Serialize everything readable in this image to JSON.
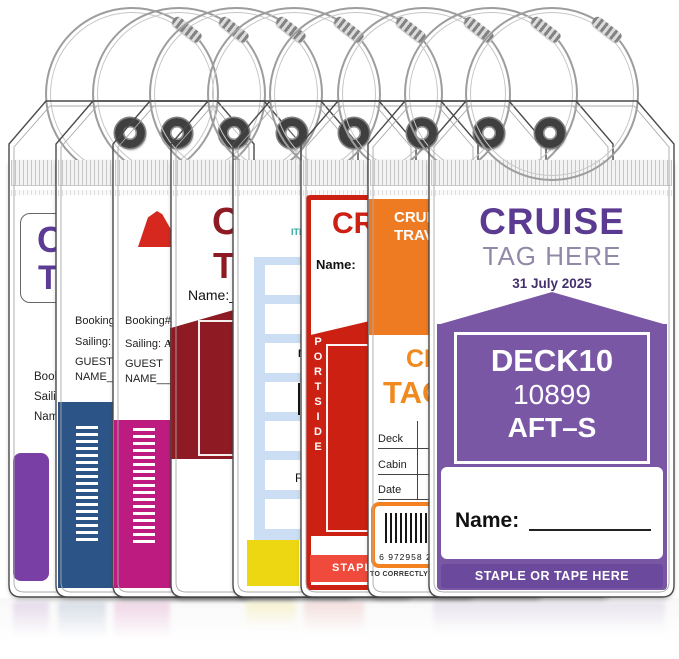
{
  "colors": {
    "front_purple_block": "#7A57A5",
    "front_purple_text": "#5B3A91",
    "front_staple_bar": "#6B4A9E",
    "orange": "#EE7B22",
    "red": "#CC2012",
    "maroon": "#8E1A24",
    "magenta": "#BE1B80",
    "navy": "#2D5486",
    "purple_block": "#7A3FA5",
    "yellow": "#EDD612",
    "table_blue": "#CBDEF3",
    "teal": "#2FA8A2"
  },
  "hardware": {
    "loop_icon": "steel-wire-loop",
    "clasp_icon": "screw-clasp",
    "grommet_icon": "metal-grommet",
    "seal_icon": "zip-seal"
  },
  "tags": [
    {
      "id": "purple-booking",
      "accent": "#7A3FA5",
      "title_line1": "CRUISE",
      "title_line2": "TAG",
      "field1": "Booking#:",
      "field2": "Sailing:",
      "field3": "Name:"
    },
    {
      "id": "navy-guest",
      "accent": "#2D5486",
      "booking_label": "Booking#:",
      "sailing_label": "Sailing:",
      "sailing_value": "JA",
      "guest_line1": "GUEST",
      "guest_line2": "NAME______"
    },
    {
      "id": "magenta-guest",
      "accent": "#BE1B80",
      "logo": "cruise-funnel",
      "booking_label": "Booking#:",
      "booking_value": "73",
      "sailing_label": "Sailing:",
      "sailing_value": "APR",
      "guest_line1": "GUEST",
      "guest_line2": "NAME______"
    },
    {
      "id": "maroon-name",
      "accent": "#8E1A24",
      "title_line1": "CRUISE",
      "title_line2": "TAG",
      "name_label": "Name:"
    },
    {
      "id": "itinerary-grid",
      "accent": "#CBDEF3",
      "header": "ITI",
      "note1": "M",
      "note2": "R"
    },
    {
      "id": "red-portside",
      "accent": "#CC2012",
      "title": "CRUISE",
      "name_label": "Name:",
      "side_label": "PORTSIDE",
      "staple_label": "STAPLE"
    },
    {
      "id": "orange-travel",
      "accent": "#EE7B22",
      "header_line1": "CRUISE",
      "header_line2": "TRAVEL",
      "title_line1": "CRUISE",
      "title_line2": "TAG",
      "row1": "Deck",
      "row2": "Cabin",
      "row3": "Date",
      "barcode_digits": "6 972958 2200",
      "footer": "TO CORRECTLY S"
    },
    {
      "id": "front-purple",
      "accent": "#7A57A5",
      "brand_line1": "CRUISE",
      "brand_line2": "TAG HERE",
      "date": "31 July 2025",
      "deck": "DECK10",
      "cabin_number": "10899",
      "deck_position": "AFT–S",
      "name_label": "Name:",
      "staple_label": "STAPLE OR TAPE HERE"
    }
  ]
}
